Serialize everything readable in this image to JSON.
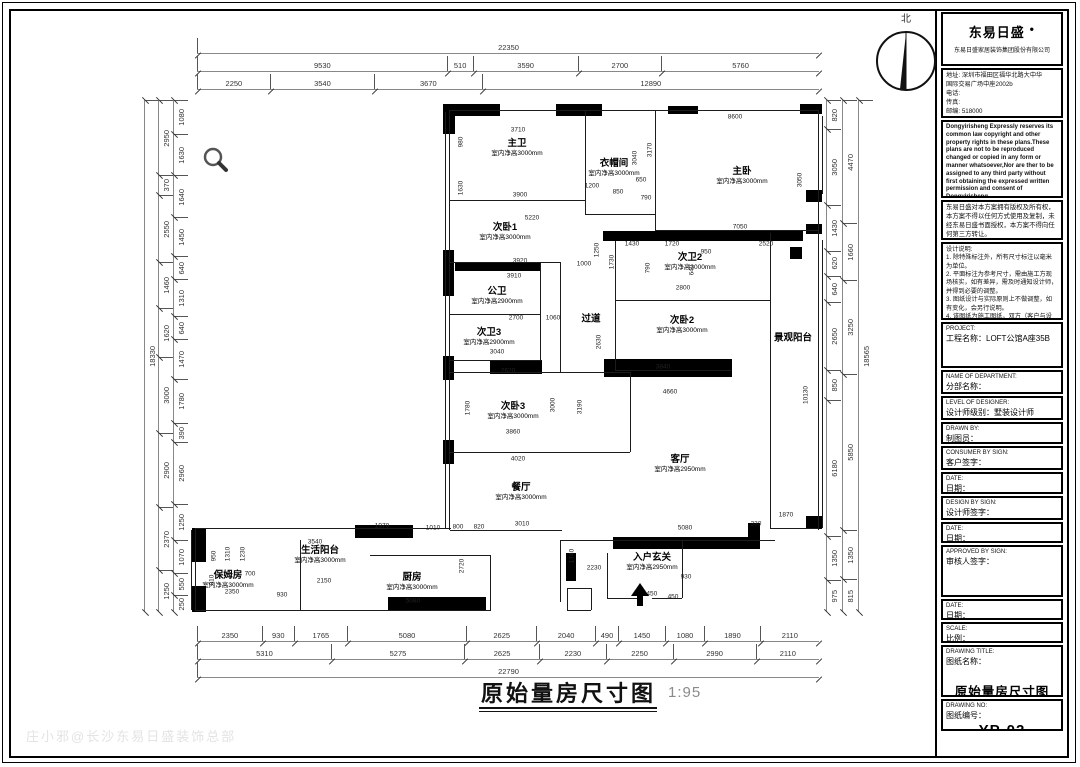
{
  "meta": {
    "north_label": "北",
    "watermark": "庄小邪@长沙东易日盛装饰总部"
  },
  "footer": {
    "title": "原始量房尺寸图",
    "scale": "1:95"
  },
  "plan": {
    "rooms": [
      {
        "name": "主卫",
        "height": "室内净高3000mm",
        "x": 517,
        "y": 148
      },
      {
        "name": "衣帽间",
        "height": "室内净高3000mm",
        "x": 614,
        "y": 168
      },
      {
        "name": "主卧",
        "height": "室内净高3000mm",
        "x": 742,
        "y": 176
      },
      {
        "name": "次卧1",
        "height": "室内净高3000mm",
        "x": 505,
        "y": 232
      },
      {
        "name": "公卫",
        "height": "室内净高2900mm",
        "x": 497,
        "y": 296
      },
      {
        "name": "次卫3",
        "height": "室内净高2900mm",
        "x": 489,
        "y": 337
      },
      {
        "name": "过道",
        "height": "",
        "x": 591,
        "y": 320
      },
      {
        "name": "次卫2",
        "height": "室内净高3000mm",
        "x": 690,
        "y": 262
      },
      {
        "name": "次卧2",
        "height": "室内净高3000mm",
        "x": 682,
        "y": 325
      },
      {
        "name": "景观阳台",
        "height": "",
        "x": 793,
        "y": 339
      },
      {
        "name": "次卧3",
        "height": "室内净高3000mm",
        "x": 513,
        "y": 411
      },
      {
        "name": "客厅",
        "height": "室内净高2950mm",
        "x": 680,
        "y": 464
      },
      {
        "name": "餐厅",
        "height": "室内净高3000mm",
        "x": 521,
        "y": 492
      },
      {
        "name": "生活阳台",
        "height": "室内净高3000mm",
        "x": 320,
        "y": 555
      },
      {
        "name": "保姆房",
        "height": "室内净高3000mm",
        "x": 228,
        "y": 580
      },
      {
        "name": "厨房",
        "height": "室内净高3000mm",
        "x": 412,
        "y": 582
      },
      {
        "name": "入户玄关",
        "height": "室内净高2950mm",
        "x": 652,
        "y": 562
      }
    ],
    "walls": [
      [
        448,
        104,
        52,
        12
      ],
      [
        556,
        104,
        46,
        12
      ],
      [
        668,
        106,
        30,
        8
      ],
      [
        800,
        104,
        22,
        10
      ],
      [
        806,
        190,
        16,
        12
      ],
      [
        806,
        224,
        16,
        10
      ],
      [
        443,
        104,
        12,
        30
      ],
      [
        443,
        250,
        11,
        46
      ],
      [
        443,
        356,
        11,
        24
      ],
      [
        443,
        440,
        11,
        24
      ],
      [
        455,
        262,
        85,
        9
      ],
      [
        603,
        231,
        200,
        10
      ],
      [
        790,
        247,
        12,
        12
      ],
      [
        490,
        360,
        52,
        14
      ],
      [
        604,
        359,
        128,
        18
      ],
      [
        613,
        537,
        138,
        12
      ],
      [
        748,
        523,
        12,
        26
      ],
      [
        806,
        516,
        16,
        13
      ],
      [
        192,
        528,
        14,
        34
      ],
      [
        192,
        586,
        14,
        26
      ],
      [
        355,
        525,
        58,
        13
      ],
      [
        388,
        597,
        98,
        13
      ],
      [
        566,
        553,
        10,
        28
      ]
    ],
    "lines": [
      [
        450,
        110,
        368,
        1
      ],
      [
        818,
        110,
        1,
        420
      ],
      [
        822,
        116,
        1,
        78
      ],
      [
        822,
        240,
        1,
        288
      ],
      [
        770,
        233,
        1,
        296
      ],
      [
        770,
        528,
        49,
        1
      ],
      [
        655,
        110,
        1,
        121
      ],
      [
        585,
        110,
        1,
        105
      ],
      [
        450,
        200,
        135,
        1
      ],
      [
        585,
        214,
        70,
        1
      ],
      [
        655,
        230,
        163,
        1
      ],
      [
        449,
        110,
        1,
        420
      ],
      [
        445,
        112,
        1,
        416
      ],
      [
        450,
        262,
        110,
        1
      ],
      [
        560,
        262,
        1,
        110
      ],
      [
        615,
        241,
        1,
        130
      ],
      [
        540,
        262,
        1,
        99
      ],
      [
        450,
        314,
        90,
        1
      ],
      [
        450,
        360,
        90,
        1
      ],
      [
        615,
        300,
        155,
        1
      ],
      [
        615,
        370,
        116,
        1
      ],
      [
        450,
        372,
        180,
        1
      ],
      [
        630,
        372,
        1,
        80
      ],
      [
        450,
        452,
        180,
        1
      ],
      [
        450,
        530,
        112,
        1
      ],
      [
        560,
        540,
        215,
        1
      ],
      [
        560,
        540,
        1,
        62
      ],
      [
        682,
        540,
        1,
        58
      ],
      [
        607,
        553,
        1,
        45
      ],
      [
        607,
        598,
        32,
        1
      ],
      [
        652,
        598,
        30,
        1
      ],
      [
        195,
        528,
        256,
        1
      ],
      [
        195,
        528,
        1,
        83
      ],
      [
        191,
        530,
        1,
        80
      ],
      [
        195,
        610,
        296,
        1
      ],
      [
        490,
        555,
        1,
        56
      ],
      [
        370,
        555,
        120,
        1
      ],
      [
        300,
        540,
        1,
        70
      ],
      [
        567,
        588,
        24,
        1
      ],
      [
        567,
        588,
        1,
        22
      ],
      [
        591,
        588,
        1,
        22
      ],
      [
        567,
        610,
        24,
        1
      ]
    ],
    "dim_labels": [
      {
        "t": "3710",
        "x": 518,
        "y": 130
      },
      {
        "t": "8600",
        "x": 735,
        "y": 117
      },
      {
        "t": "980",
        "x": 461,
        "y": 142,
        "v": 1
      },
      {
        "t": "1630",
        "x": 461,
        "y": 188,
        "v": 1
      },
      {
        "t": "3900",
        "x": 520,
        "y": 195
      },
      {
        "t": "5220",
        "x": 532,
        "y": 218
      },
      {
        "t": "1200",
        "x": 592,
        "y": 186
      },
      {
        "t": "850",
        "x": 618,
        "y": 192
      },
      {
        "t": "650",
        "x": 641,
        "y": 180
      },
      {
        "t": "790",
        "x": 646,
        "y": 198
      },
      {
        "t": "3040",
        "x": 635,
        "y": 158,
        "v": 1
      },
      {
        "t": "3170",
        "x": 650,
        "y": 150,
        "v": 1
      },
      {
        "t": "3050",
        "x": 800,
        "y": 180,
        "v": 1
      },
      {
        "t": "7050",
        "x": 740,
        "y": 227
      },
      {
        "t": "1430",
        "x": 632,
        "y": 244
      },
      {
        "t": "1720",
        "x": 672,
        "y": 244
      },
      {
        "t": "950",
        "x": 706,
        "y": 252
      },
      {
        "t": "2520",
        "x": 766,
        "y": 244
      },
      {
        "t": "1250",
        "x": 597,
        "y": 250,
        "v": 1
      },
      {
        "t": "1730",
        "x": 612,
        "y": 262,
        "v": 1
      },
      {
        "t": "790",
        "x": 648,
        "y": 268,
        "v": 1
      },
      {
        "t": "640",
        "x": 692,
        "y": 270,
        "v": 1
      },
      {
        "t": "2800",
        "x": 683,
        "y": 288
      },
      {
        "t": "3920",
        "x": 520,
        "y": 261
      },
      {
        "t": "3910",
        "x": 514,
        "y": 276
      },
      {
        "t": "1000",
        "x": 584,
        "y": 264
      },
      {
        "t": "2700",
        "x": 516,
        "y": 318
      },
      {
        "t": "1060",
        "x": 553,
        "y": 318
      },
      {
        "t": "3040",
        "x": 497,
        "y": 352
      },
      {
        "t": "2620",
        "x": 508,
        "y": 371
      },
      {
        "t": "2630",
        "x": 599,
        "y": 342,
        "v": 1
      },
      {
        "t": "3840",
        "x": 663,
        "y": 367
      },
      {
        "t": "4660",
        "x": 670,
        "y": 392
      },
      {
        "t": "1780",
        "x": 468,
        "y": 408,
        "v": 1
      },
      {
        "t": "3000",
        "x": 553,
        "y": 405,
        "v": 1
      },
      {
        "t": "3190",
        "x": 580,
        "y": 407,
        "v": 1
      },
      {
        "t": "3860",
        "x": 513,
        "y": 432
      },
      {
        "t": "4020",
        "x": 518,
        "y": 459
      },
      {
        "t": "10130",
        "x": 806,
        "y": 395,
        "v": 1
      },
      {
        "t": "1870",
        "x": 786,
        "y": 515
      },
      {
        "t": "330",
        "x": 756,
        "y": 524
      },
      {
        "t": "5080",
        "x": 685,
        "y": 528
      },
      {
        "t": "3010",
        "x": 522,
        "y": 524
      },
      {
        "t": "1740",
        "x": 572,
        "y": 556,
        "v": 1
      },
      {
        "t": "2230",
        "x": 594,
        "y": 568
      },
      {
        "t": "930",
        "x": 686,
        "y": 577
      },
      {
        "t": "1450",
        "x": 650,
        "y": 594
      },
      {
        "t": "450",
        "x": 673,
        "y": 597
      },
      {
        "t": "1970",
        "x": 382,
        "y": 526
      },
      {
        "t": "1010",
        "x": 433,
        "y": 528
      },
      {
        "t": "800",
        "x": 458,
        "y": 527
      },
      {
        "t": "820",
        "x": 479,
        "y": 527
      },
      {
        "t": "3540",
        "x": 315,
        "y": 542
      },
      {
        "t": "2150",
        "x": 324,
        "y": 581
      },
      {
        "t": "2350",
        "x": 232,
        "y": 592
      },
      {
        "t": "930",
        "x": 282,
        "y": 595
      },
      {
        "t": "5080",
        "x": 413,
        "y": 601
      },
      {
        "t": "2720",
        "x": 462,
        "y": 566,
        "v": 1
      },
      {
        "t": "950",
        "x": 214,
        "y": 556,
        "v": 1
      },
      {
        "t": "1310",
        "x": 228,
        "y": 554,
        "v": 1
      },
      {
        "t": "1230",
        "x": 243,
        "y": 554,
        "v": 1
      },
      {
        "t": "810",
        "x": 212,
        "y": 580,
        "v": 1
      },
      {
        "t": "700",
        "x": 250,
        "y": 574
      }
    ],
    "chains": {
      "top": [
        {
          "y": 38,
          "segs": [
            "22350"
          ]
        },
        {
          "y": 56,
          "segs": [
            "9530",
            "510",
            "3590",
            "2700",
            "5760"
          ]
        },
        {
          "y": 74,
          "segs": [
            "2250",
            "3540",
            "3670",
            "12890"
          ]
        }
      ],
      "bottom": [
        {
          "y": 626,
          "segs": [
            "2350",
            "930",
            "1765",
            "5080",
            "2625",
            "2040",
            "490",
            "1450",
            "1080",
            "1890",
            "2110"
          ]
        },
        {
          "y": 644,
          "segs": [
            "5310",
            "5275",
            "2625",
            "2230",
            "2250",
            "2990",
            "2110"
          ]
        },
        {
          "y": 662,
          "segs": [
            "22790"
          ]
        }
      ],
      "left": [
        {
          "x": 144,
          "segs": [
            "18330"
          ]
        },
        {
          "x": 158,
          "segs": [
            "2950",
            "370",
            "2550",
            "1460",
            "1620",
            "3000",
            "2900",
            "2370",
            "1250"
          ]
        },
        {
          "x": 173,
          "segs": [
            "1080",
            "1630",
            "1640",
            "1450",
            "640",
            "1310",
            "640",
            "1470",
            "1780",
            "390",
            "2960",
            "1250",
            "1070",
            "550",
            "250"
          ]
        }
      ],
      "right": [
        {
          "x": 826,
          "segs": [
            "820",
            "3050",
            "1430",
            "620",
            "640",
            "2650",
            "850",
            "6180",
            "1350",
            "975"
          ]
        },
        {
          "x": 842,
          "segs": [
            "4470",
            "1660",
            "3250",
            "5850",
            "1350",
            "815"
          ]
        },
        {
          "x": 858,
          "segs": [
            "18565"
          ]
        }
      ]
    }
  },
  "titleblock": {
    "logo": "东易日盛",
    "logo_dot": "●",
    "company": "东易日盛家居装饰集团股份有限公司",
    "address_lines": [
      "地址: 深圳市福田区福华北路大中华",
      "国际交易广场中座2002b",
      "电话:",
      "传真:",
      "邮编: 518000",
      "http：//www.dyrs.com.cn"
    ],
    "copyright_en": "Dongyirisheng Expressly reserves its common law copyright and other property rights in these plans.These plans are not to be reproduced changed or copied in any form or manner whatsoever,Nor are ther to be assigned to any third party without first obtaining the expressed written permission and consent of Dongyirisheng",
    "copyright_cn": "东易日盛对本方案拥有版权及所有权，本方案不得以任何方式使用及复制，未经东易日盛书面授权，本方案不得向任何第三方转让。",
    "notes_title": "设计说明:",
    "notes": [
      "1. 除特殊标注外，所有尺寸标注以毫米为单位。",
      "2. 平面标注为参考尺寸，需由施工方现场核实，如有差异，需及时通知设计师，并得到必要的调整。",
      "3. 图纸设计与实际原则上不做调整，如有变化，会另行说明。",
      "4. 该图纸为施工图纸，双方（客户与设计师）签字认可后，方可指导施工。"
    ],
    "rows": [
      {
        "en": "PROJECT:",
        "cn": "工程名称：LOFT公馆A座35B",
        "h": 46
      },
      {
        "en": "NAME OF DEPARTMENT:",
        "cn": "分部名称：",
        "h": 24
      },
      {
        "en": "LEVEL OF DESIGNER:",
        "cn": "设计师级别：墅装设计师",
        "h": 24
      },
      {
        "en": "DRAWN BY:",
        "cn": "制图员：",
        "h": 22
      },
      {
        "en": "CONSUMER BY SIGN:",
        "cn": "客户签字：",
        "h": 24
      },
      {
        "en": "DATE:",
        "cn": "日期：",
        "h": 22
      },
      {
        "en": "DESIGN BY SIGN:",
        "cn": "设计师签字：",
        "h": 24
      },
      {
        "en": "DATE:",
        "cn": "日期：",
        "h": 21
      },
      {
        "en": "APPROVED BY SIGN:",
        "cn": "审核人签字：",
        "h": 52
      },
      {
        "en": "DATE:",
        "cn": "日期：",
        "h": 21
      },
      {
        "en": "SCALE:",
        "cn": "比例：",
        "h": 21
      },
      {
        "en": "DRAWING TITLE:",
        "cn": "图纸名称：",
        "big": "原始量房尺寸图",
        "h": 52
      },
      {
        "en": "DRAWING NO:",
        "cn": "图纸编号：",
        "big_no": "YP-02",
        "h": 32
      }
    ]
  }
}
